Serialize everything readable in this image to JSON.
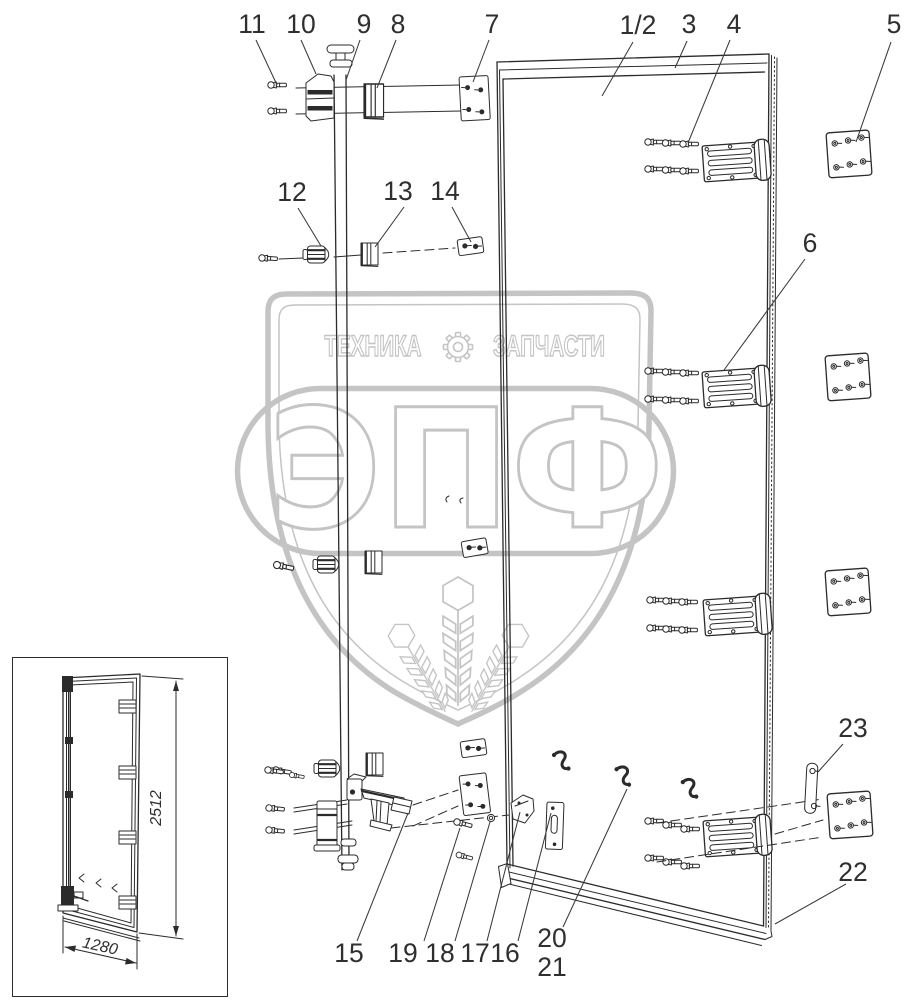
{
  "watermark": {
    "left_text": "ТЕХНИКА",
    "right_text": "ЗАПЧАСТИ",
    "logo_text": "ЭПФ",
    "gear_icon": "gear-icon",
    "color": "#c4c4c4"
  },
  "inset": {
    "height_label": "2512",
    "width_label": "1280"
  },
  "colors": {
    "line": "#2b2b2b",
    "label": "#2f2f2f",
    "watermark": "#c4c4c4",
    "background": "#ffffff"
  },
  "callouts": [
    {
      "label": "11",
      "tx": 252,
      "ty": 33,
      "x1": 256,
      "y1": 40,
      "x2": 277,
      "y2": 85
    },
    {
      "label": "10",
      "tx": 301,
      "ty": 33,
      "x1": 301,
      "y1": 40,
      "x2": 316,
      "y2": 74
    },
    {
      "label": "9",
      "tx": 364,
      "ty": 33,
      "x1": 360,
      "y1": 40,
      "x2": 346,
      "y2": 80
    },
    {
      "label": "8",
      "tx": 398,
      "ty": 33,
      "x1": 396,
      "y1": 40,
      "x2": 377,
      "y2": 88
    },
    {
      "label": "7",
      "tx": 492,
      "ty": 33,
      "x1": 489,
      "y1": 40,
      "x2": 473,
      "y2": 82
    },
    {
      "label": "1/2",
      "tx": 638,
      "ty": 34,
      "x1": 633,
      "y1": 42,
      "x2": 602,
      "y2": 96
    },
    {
      "label": "3",
      "tx": 689,
      "ty": 33,
      "x1": 687,
      "y1": 41,
      "x2": 675,
      "y2": 68
    },
    {
      "label": "4",
      "tx": 734,
      "ty": 33,
      "x1": 730,
      "y1": 40,
      "x2": 688,
      "y2": 143
    },
    {
      "label": "5",
      "tx": 894,
      "ty": 33,
      "x1": 891,
      "y1": 42,
      "x2": 856,
      "y2": 142
    },
    {
      "label": "6",
      "tx": 810,
      "ty": 252,
      "x1": 805,
      "y1": 259,
      "x2": 724,
      "y2": 370
    },
    {
      "label": "12",
      "tx": 292,
      "ty": 201,
      "x1": 298,
      "y1": 208,
      "x2": 321,
      "y2": 246
    },
    {
      "label": "13",
      "tx": 398,
      "ty": 200,
      "x1": 404,
      "y1": 207,
      "x2": 375,
      "y2": 247
    },
    {
      "label": "14",
      "tx": 445,
      "ty": 200,
      "x1": 452,
      "y1": 207,
      "x2": 471,
      "y2": 242
    },
    {
      "label": "23",
      "tx": 853,
      "ty": 737,
      "x1": 843,
      "y1": 744,
      "x2": 818,
      "y2": 772
    },
    {
      "label": "22",
      "tx": 853,
      "ty": 881,
      "x1": 846,
      "y1": 884,
      "x2": 775,
      "y2": 924
    },
    {
      "label": "15",
      "tx": 349,
      "ty": 962,
      "x1": 357,
      "y1": 941,
      "x2": 408,
      "y2": 813
    },
    {
      "label": "19",
      "tx": 403,
      "ty": 962,
      "x1": 424,
      "y1": 941,
      "x2": 460,
      "y2": 828
    },
    {
      "label": "18",
      "tx": 440,
      "ty": 962,
      "x1": 455,
      "y1": 941,
      "x2": 490,
      "y2": 822
    },
    {
      "label": "17",
      "tx": 475,
      "ty": 962,
      "x1": 487,
      "y1": 941,
      "x2": 520,
      "y2": 812
    },
    {
      "label": "16",
      "tx": 505,
      "ty": 962,
      "x1": 518,
      "y1": 941,
      "x2": 551,
      "y2": 813
    },
    {
      "label": "20",
      "tx": 552,
      "ty": 947,
      "x1": 563,
      "y1": 927,
      "x2": 627,
      "y2": 789
    },
    {
      "label": "21",
      "tx": 552,
      "ty": 976
    }
  ]
}
